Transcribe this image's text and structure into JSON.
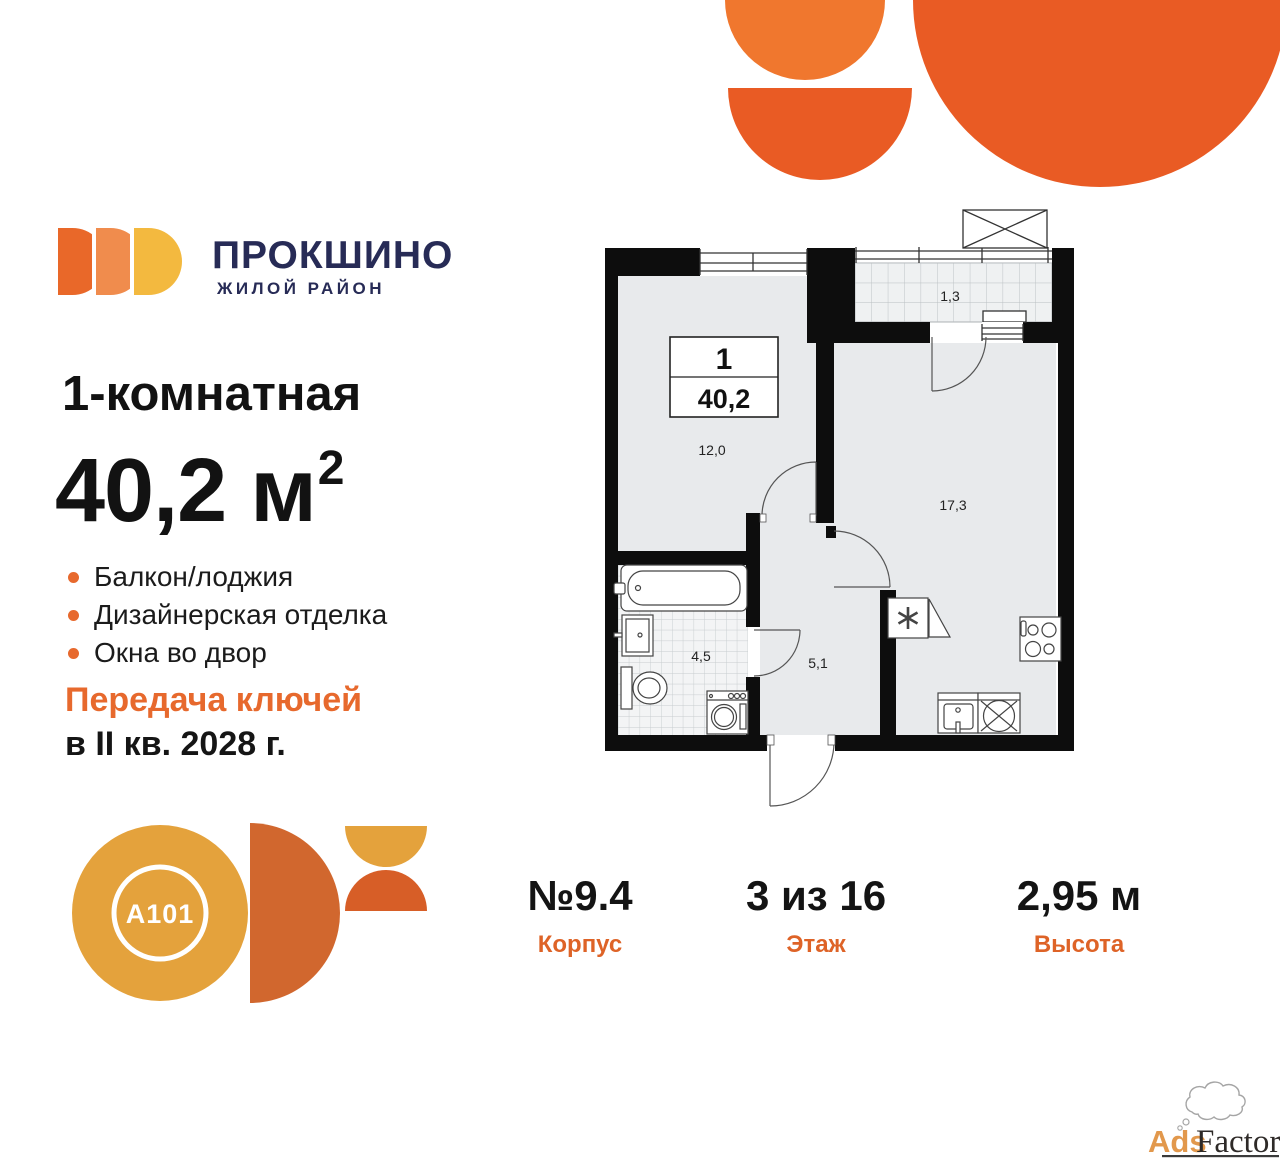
{
  "brand": {
    "district_name": "ПРОКШИНО",
    "district_tagline": "ЖИЛОЙ РАЙОН",
    "developer": "A101"
  },
  "listing": {
    "type_title": "1-комнатная",
    "area_value": "40,2",
    "area_unit": "м",
    "area_exponent": "2",
    "features": [
      "Балкон/лоджия",
      "Дизайнерская отделка",
      "Окна во двор"
    ],
    "handover_title": "Передача ключей",
    "handover_date": "в II кв. 2028 г."
  },
  "floor_plan": {
    "legend_rooms": "1",
    "legend_area": "40,2",
    "labels": {
      "balcony": "1,3",
      "bedroom": "12,0",
      "living": "17,3",
      "bathroom": "4,5",
      "hallway": "5,1"
    }
  },
  "details": [
    {
      "value": "№9.4",
      "label": "Корпус"
    },
    {
      "value": "3 из 16",
      "label": "Этаж"
    },
    {
      "value": "2,95 м",
      "label": "Высота"
    }
  ],
  "watermark": {
    "part1": "Ads",
    "part2": "Factory"
  },
  "colors": {
    "accent_orange": "#E7692D",
    "deco_light_orange": "#F0772E",
    "deco_dark_orange": "#E95B24",
    "petal_1": "#E96829",
    "petal_2": "#F08C4D",
    "petal_3": "#F3B93F",
    "navy": "#272B56",
    "a101_yellow": "#E4A23C",
    "a101_orange": "#D1672E",
    "a101_red_orange": "#D75E27",
    "plan_room_fill": "#E8EAEC",
    "wall_black": "#0D0D0D"
  }
}
